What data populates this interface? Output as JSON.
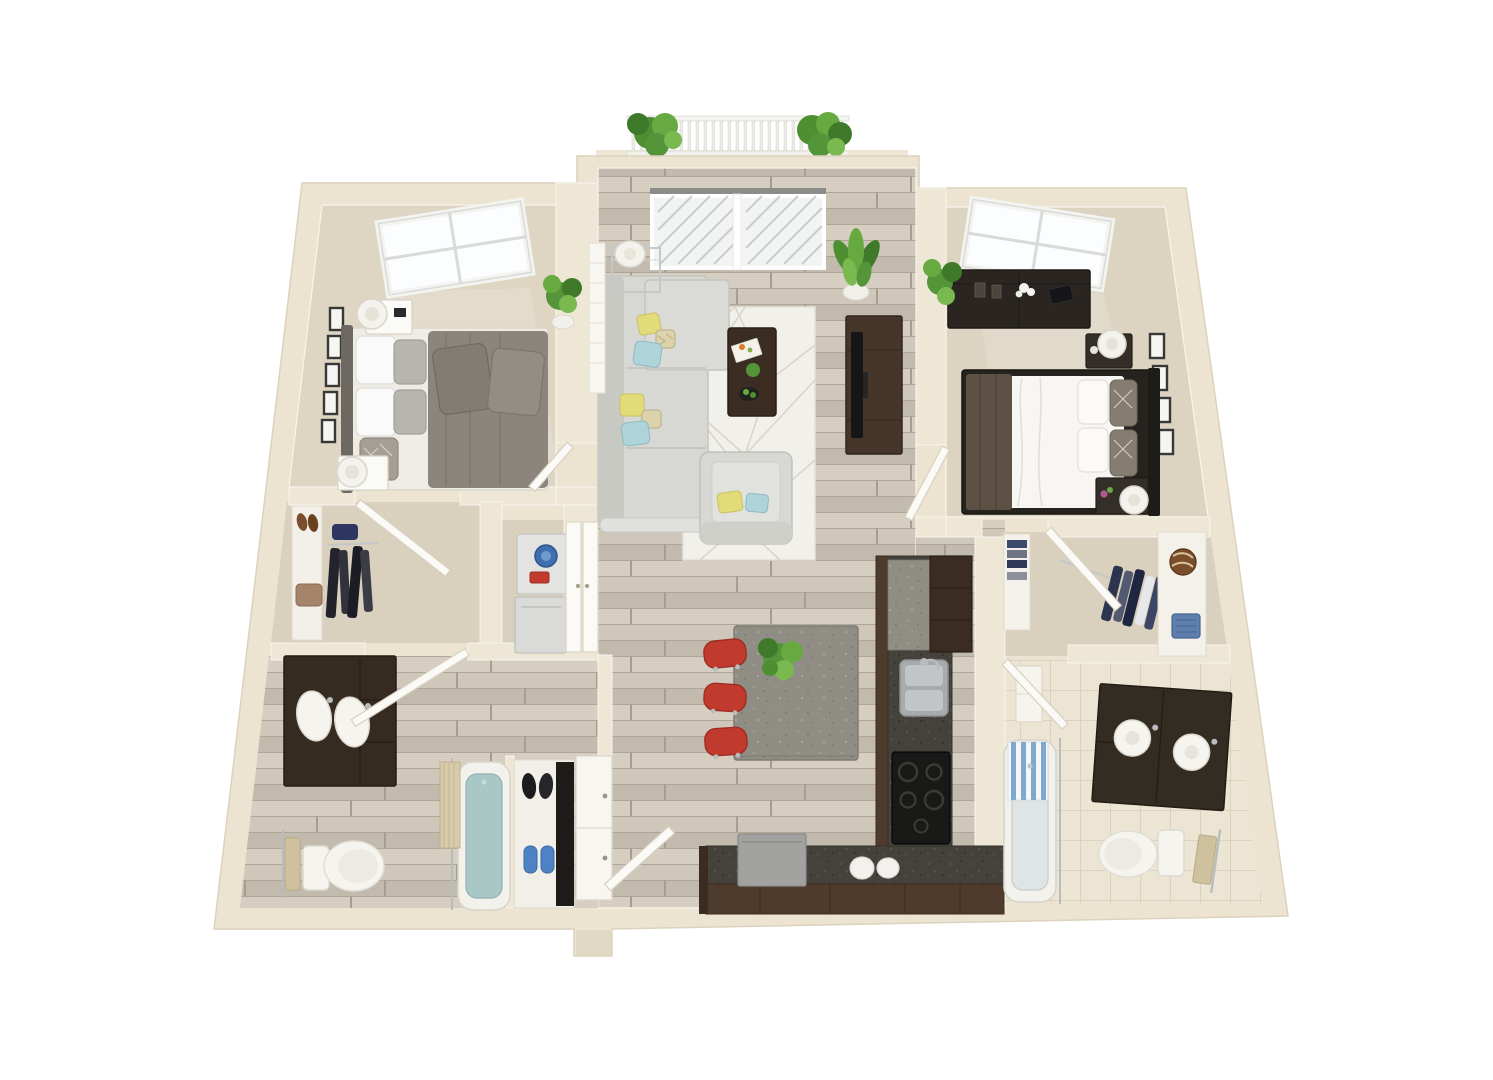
{
  "scene": {
    "type": "3d-floor-plan-render",
    "view": "top-down perspective dollhouse",
    "background": "#ffffff",
    "bedrooms": 2,
    "bathrooms": 2,
    "text_labels": []
  },
  "palette": {
    "wall": "#ece4d1",
    "wall_stroke": "#dcd2bd",
    "wall_inner": "#eee7d5",
    "wall_shadow": "#e2d9c4",
    "trim_white": "#f8f5ee",
    "carpet1": "#ded5c3",
    "carpet2": "#dcd3c1",
    "carpet_closet": "#d9d0be",
    "laundry_floor": "#d8cfbd",
    "wood_a": "#cfc7ba",
    "wood_b": "#c2baad",
    "wood_c": "#d6cec1",
    "wood_seam": "#b0a697",
    "wood_joint": "#a89e8f",
    "tile_base": "#ece5d4",
    "tile_line": "#d7cdb9",
    "cabinet": "#4e3b2b",
    "cabinet_dark": "#3a2c20",
    "counter_dark": "#45413b",
    "counter_speck": "#57534c",
    "island_gray": "#908d84",
    "sofa": "#d7d7d3",
    "sofa_shade": "#c9c9c4",
    "rug": "#f2f0ea",
    "rug_line": "#d9d5cd",
    "bed1_duvet": "#8b857d",
    "bed2_mattress": "#f7f6f2",
    "bed2_throw": "#5d5044",
    "bed_frame_dark": "#26231f",
    "accent_yellow": "#e3db7a",
    "accent_blue": "#aed4da",
    "accent_red": "#c13a2e",
    "plant": "#55953a",
    "plant_dark": "#3f7a2a",
    "plant_light": "#7ab94f",
    "water_teal": "#a9c7c5",
    "tub_inner_blue": "#dfe5e4",
    "curtain_tan": "#d8cbaa",
    "curtain_blue": "#7fa8cc",
    "towel_tan": "#cfc19e",
    "fixture_white": "#f6f4ef",
    "chrome": "#b9bcbe",
    "appliance_gray": "#a2a2a0",
    "washer_white": "#e3e3e1",
    "door_white": "#fbfaf7",
    "glass": "#f2f4f3",
    "dark_appliance": "#191918"
  },
  "rooms": [
    {
      "id": "balcony",
      "name": "Balcony",
      "floor": "concrete",
      "furniture": [
        "railing",
        "planter-plants"
      ]
    },
    {
      "id": "bedroom-1",
      "name": "Bedroom 1",
      "floor": "carpet",
      "furniture": [
        "queen-bed-gray",
        "headboard",
        "nightstand x2",
        "table-lamp x2",
        "gallery-frames x5",
        "window"
      ]
    },
    {
      "id": "living-room",
      "name": "Living Room",
      "floor": "hardwood",
      "furniture": [
        "sectional-sofa",
        "throw-pillows",
        "area-rug",
        "coffee-table",
        "armchair",
        "tv-console",
        "tv",
        "console-table",
        "table-lamp",
        "potted-plants",
        "sliding-glass-door"
      ]
    },
    {
      "id": "bedroom-2",
      "name": "Bedroom 2",
      "floor": "carpet",
      "furniture": [
        "queen-bed-white",
        "dresser",
        "nightstand x2",
        "table-lamp x2",
        "gallery-frames x4",
        "window",
        "potted-plant"
      ]
    },
    {
      "id": "walk-in-closet-1",
      "name": "Walk-in Closet 1",
      "floor": "carpet",
      "furniture": [
        "shoe-shelf",
        "hanging-clothes",
        "bag"
      ]
    },
    {
      "id": "laundry-closet",
      "name": "Laundry Closet",
      "floor": "carpet",
      "furniture": [
        "stacked-washer-dryer",
        "bifold-doors",
        "detergent"
      ]
    },
    {
      "id": "bathroom-1",
      "name": "Bathroom 1",
      "floor": "hardwood",
      "furniture": [
        "double-sink-vanity",
        "toilet",
        "towel-bar",
        "bathtub",
        "shower-curtain",
        "shoe-closet",
        "pantry-cabinet"
      ]
    },
    {
      "id": "kitchen",
      "name": "Kitchen",
      "floor": "hardwood",
      "furniture": [
        "l-shaped-counter",
        "double-sink",
        "cooktop",
        "dishwasher",
        "tall-cabinet-fridge",
        "canisters",
        "island",
        "bar-stools x3",
        "island-plant"
      ]
    },
    {
      "id": "entry",
      "name": "Entry",
      "floor": "hardwood",
      "furniture": [
        "front-door"
      ]
    },
    {
      "id": "walk-in-closet-2",
      "name": "Walk-in Closet 2",
      "floor": "carpet",
      "furniture": [
        "shelving",
        "folded-clothes",
        "hanging-clothes",
        "towel-roll",
        "basket"
      ]
    },
    {
      "id": "bathroom-2",
      "name": "Bathroom 2",
      "floor": "tile",
      "furniture": [
        "double-sink-vanity",
        "toilet",
        "towel-bar",
        "bathtub",
        "striped-shower-curtain",
        "linen-cabinet"
      ]
    }
  ]
}
